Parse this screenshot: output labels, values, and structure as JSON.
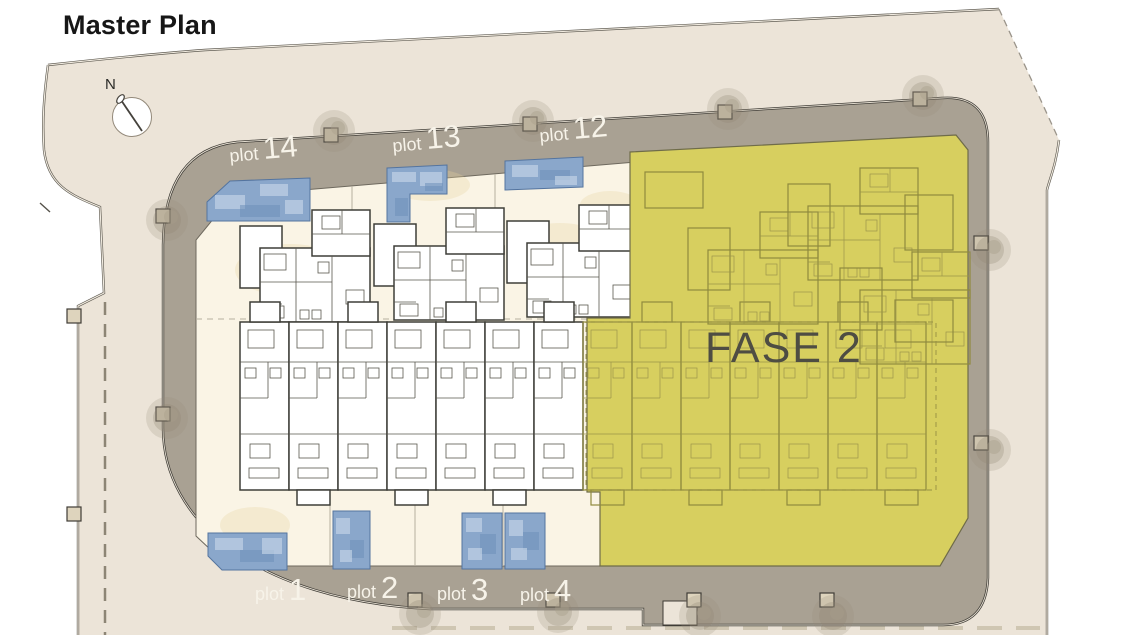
{
  "title": "Master Plan",
  "compass": {
    "label": "N"
  },
  "phase": {
    "label": "FASE 2"
  },
  "plots": {
    "top": [
      {
        "word": "plot",
        "number": "14"
      },
      {
        "word": "plot",
        "number": "13"
      },
      {
        "word": "plot",
        "number": "12"
      }
    ],
    "bottom": [
      {
        "word": "plot",
        "number": "1"
      },
      {
        "word": "plot",
        "number": "2"
      },
      {
        "word": "plot",
        "number": "3"
      },
      {
        "word": "plot",
        "number": "4"
      }
    ]
  },
  "colors": {
    "phase_overlay": "#d7cf5f",
    "road": "#a9a193",
    "pool": "#8aa7cb",
    "land": "#ece4d8"
  }
}
